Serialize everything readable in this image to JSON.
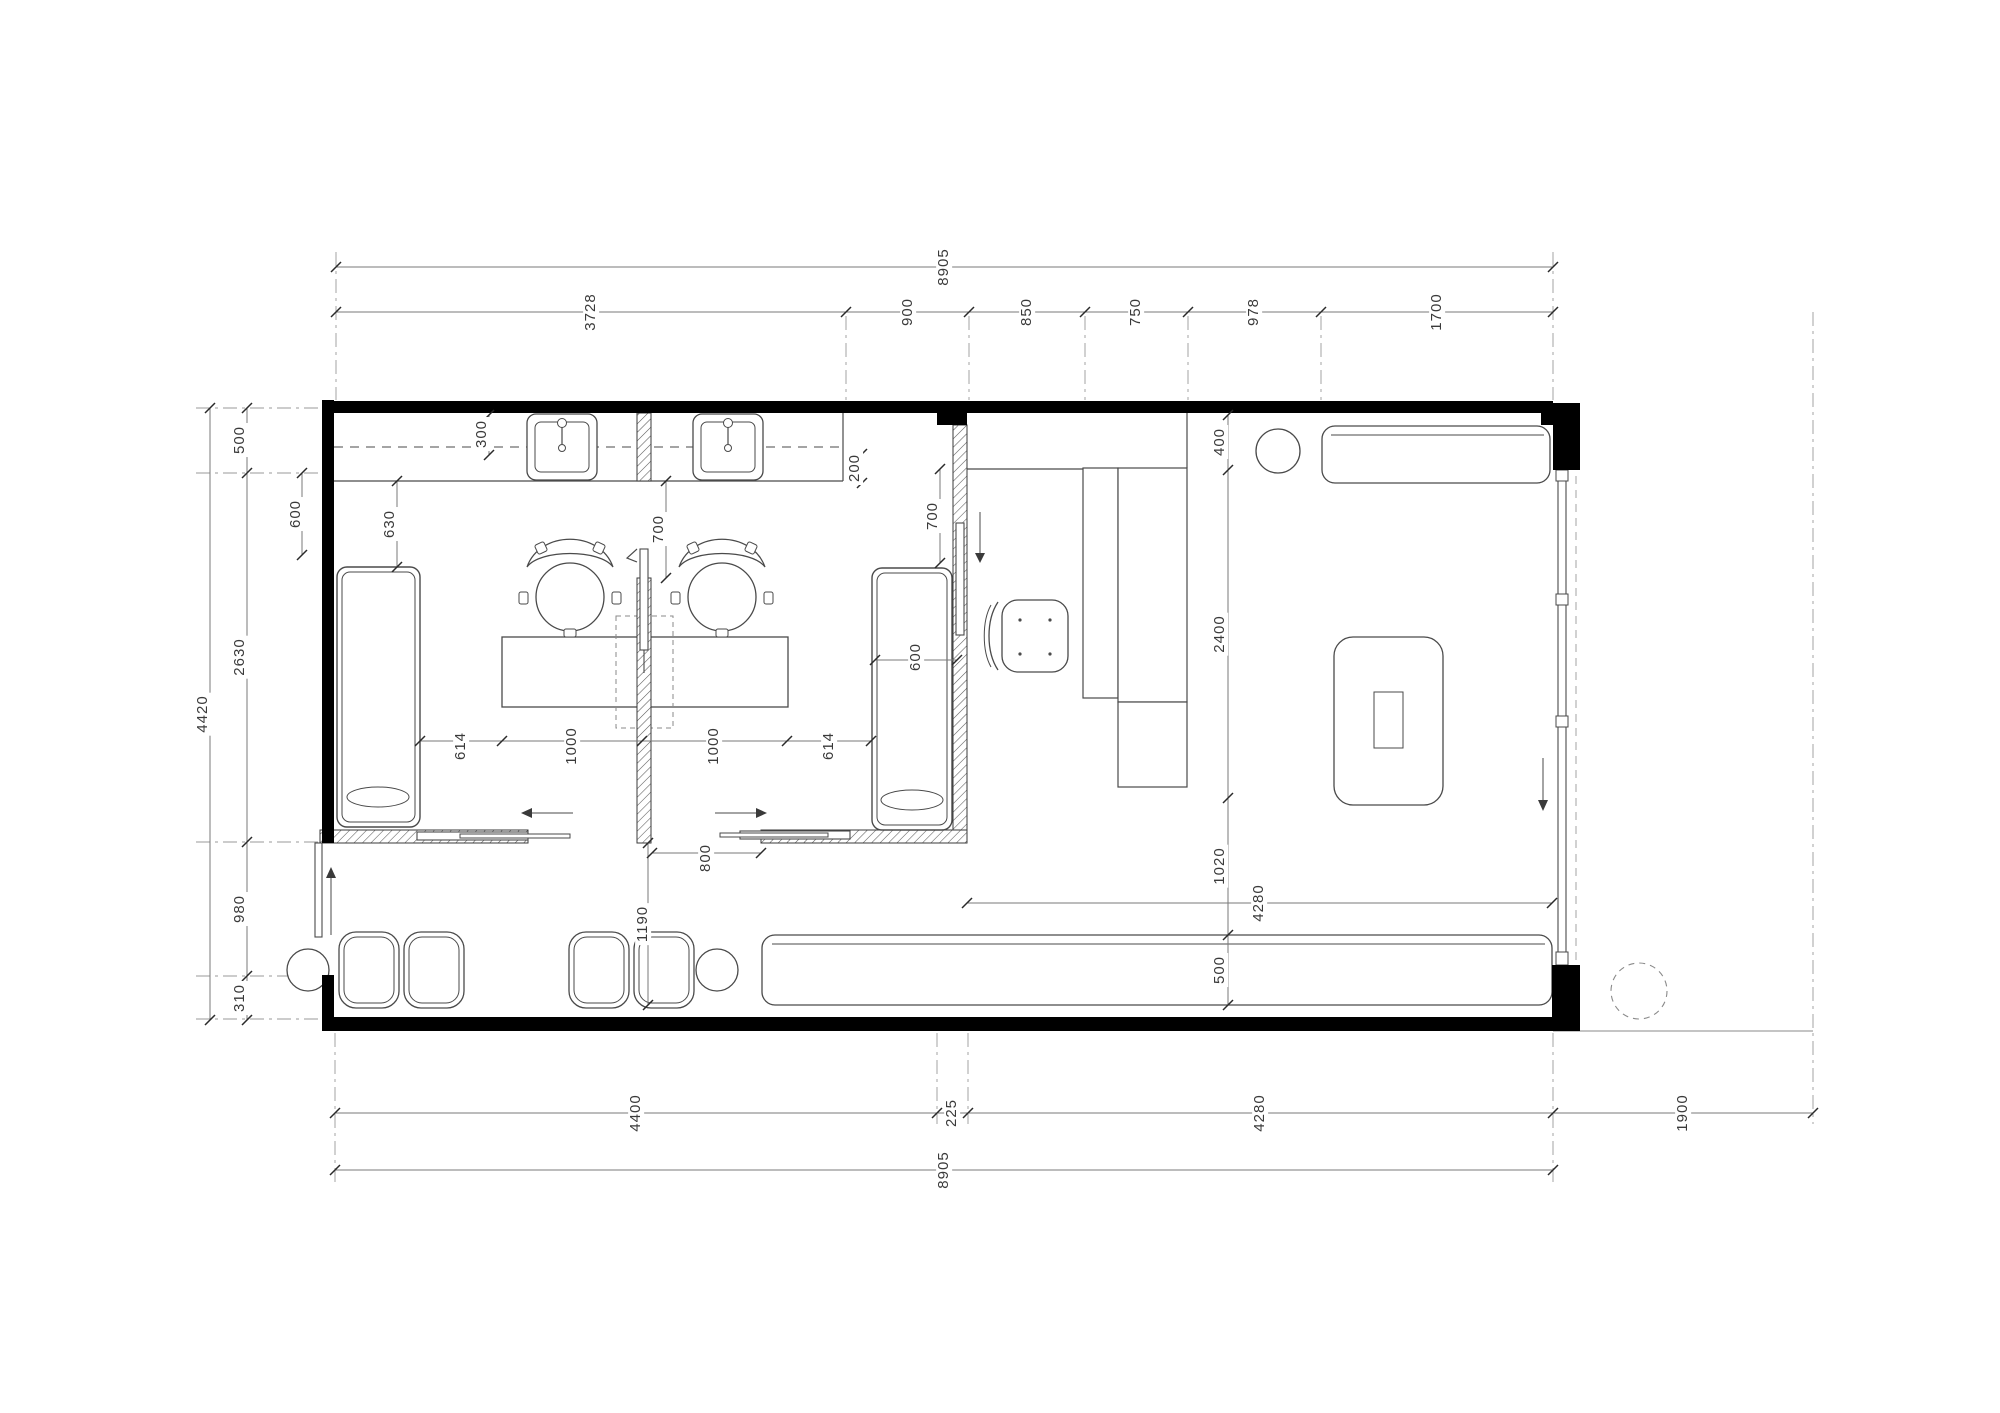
{
  "sheet": {
    "type": "floor-plan",
    "units": "mm",
    "line_color": "#4a4a4a",
    "wall_color": "#000000",
    "dim_color": "#3a3a3a"
  },
  "dims": {
    "top": {
      "overall": "8905",
      "chain": [
        "3728",
        "900",
        "850",
        "750",
        "978",
        "1700"
      ]
    },
    "left": {
      "overall": "4420",
      "chain": [
        "500",
        "2630",
        "980",
        "310"
      ]
    },
    "right": {
      "chain": [
        "400",
        "2400",
        "1020",
        "500"
      ]
    },
    "inner": {
      "furniture_row": [
        "614",
        "1000",
        "1000",
        "614"
      ],
      "door_opening": "800",
      "corridor": "1190",
      "lounge_width": "4280",
      "bed1_offset": "630",
      "counter_depth": "300",
      "room1_door_clear": "700",
      "room2_counter_edge": "200",
      "room2_door_clear": "700",
      "bed1_width": "600",
      "bed2_width": "600"
    },
    "bottom": {
      "chain": [
        "4400",
        "225",
        "4280"
      ],
      "site_offset": "1900",
      "overall": "8905"
    }
  }
}
